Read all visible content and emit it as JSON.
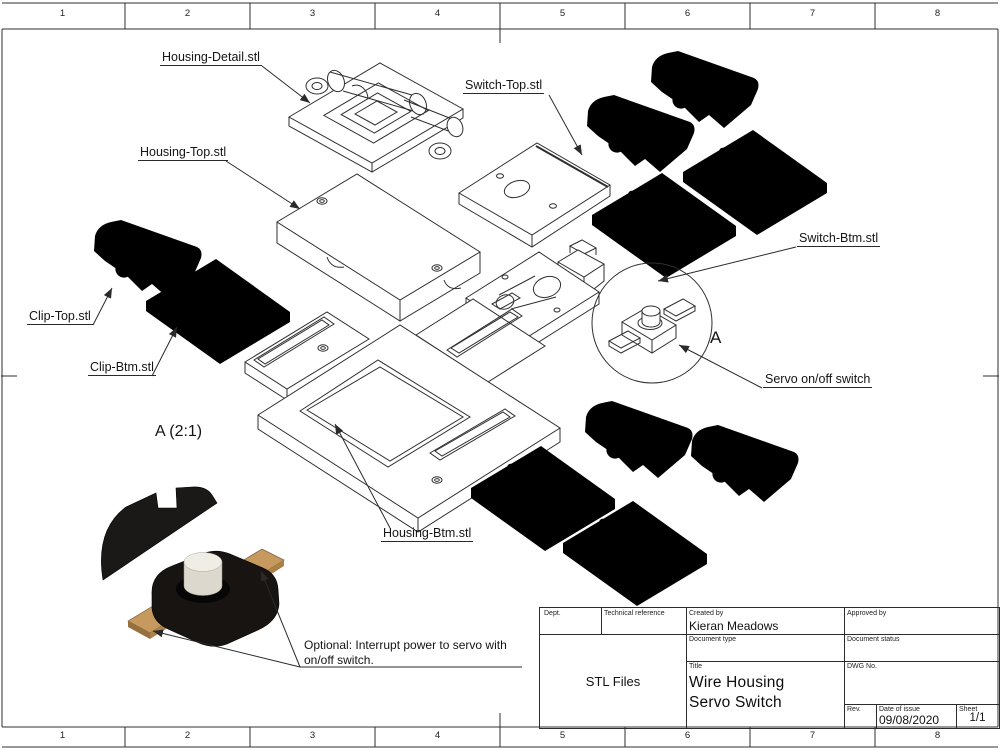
{
  "sheet": {
    "zones": [
      "1",
      "2",
      "3",
      "4",
      "5",
      "6",
      "7",
      "8"
    ]
  },
  "part_labels": {
    "housing_detail": "Housing-Detail.stl",
    "switch_top": "Switch-Top.stl",
    "housing_top": "Housing-Top.stl",
    "switch_btm": "Switch-Btm.stl",
    "clip_top": "Clip-Top.stl",
    "clip_btm": "Clip-Btm.stl",
    "housing_btm": "Housing-Btm.stl",
    "servo_switch": "Servo on/off switch",
    "detail_view_title": "A (2:1)",
    "detail_marker": "A"
  },
  "note": {
    "line1": "Optional: Interrupt power to servo with",
    "line2": "on/off switch."
  },
  "title_block": {
    "dept_label": "Dept.",
    "technical_reference_label": "Technical reference",
    "created_by_label": "Created by",
    "created_by": "Kieran Meadows",
    "approved_by_label": "Approved by",
    "document_type_label": "Document type",
    "document_status_label": "Document status",
    "document_type_value": "STL Files",
    "title_label": "Title",
    "title_line1": "Wire Housing",
    "title_line2": "Servo Switch",
    "dwg_no_label": "DWG No.",
    "rev_label": "Rev.",
    "date_of_issue_label": "Date of issue",
    "date_of_issue": "09/08/2020",
    "sheet_label": "Sheet",
    "sheet_value": "1/1"
  },
  "colors": {
    "line": "#2f2f2f",
    "switch_body": "#171411",
    "switch_button": "#f0ede5",
    "switch_lead": "#c69a5e"
  }
}
